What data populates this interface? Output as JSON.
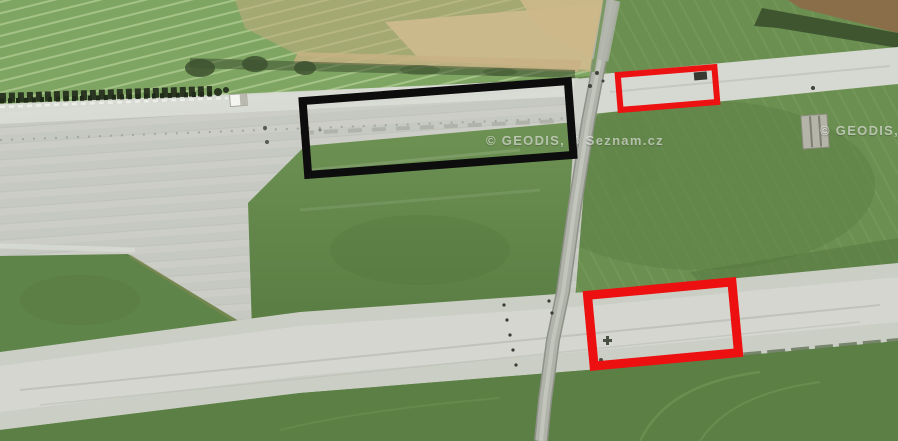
{
  "watermark": {
    "text": "© GEODIS, © Seznam.cz"
  },
  "annotations": {
    "black_box": {
      "x": 301,
      "y": 87,
      "width": 274,
      "height": 82,
      "angle": -4.3,
      "border_width": 8,
      "color": "#0d0d0d"
    },
    "red_box_top": {
      "x": 616,
      "y": 68,
      "width": 103,
      "height": 41,
      "angle": -4.7,
      "border_width": 6,
      "color": "#ec1212"
    },
    "red_box_bottom": {
      "x": 586,
      "y": 284,
      "width": 154,
      "height": 80,
      "angle": -5.3,
      "border_width": 9,
      "color": "#ec1010"
    }
  },
  "palette": {
    "grass_base": "#6b8f51",
    "field_bright": "#7ea562",
    "field_harvested_tan": "#c2ac7e",
    "concrete_apron": "#c6c9c1",
    "runway_light": "#d6d8d2",
    "road": "#b0b3aa",
    "hedge_dark": "#2a3621",
    "annotation_black": "#0d0d0d",
    "annotation_red": "#ec1212"
  }
}
